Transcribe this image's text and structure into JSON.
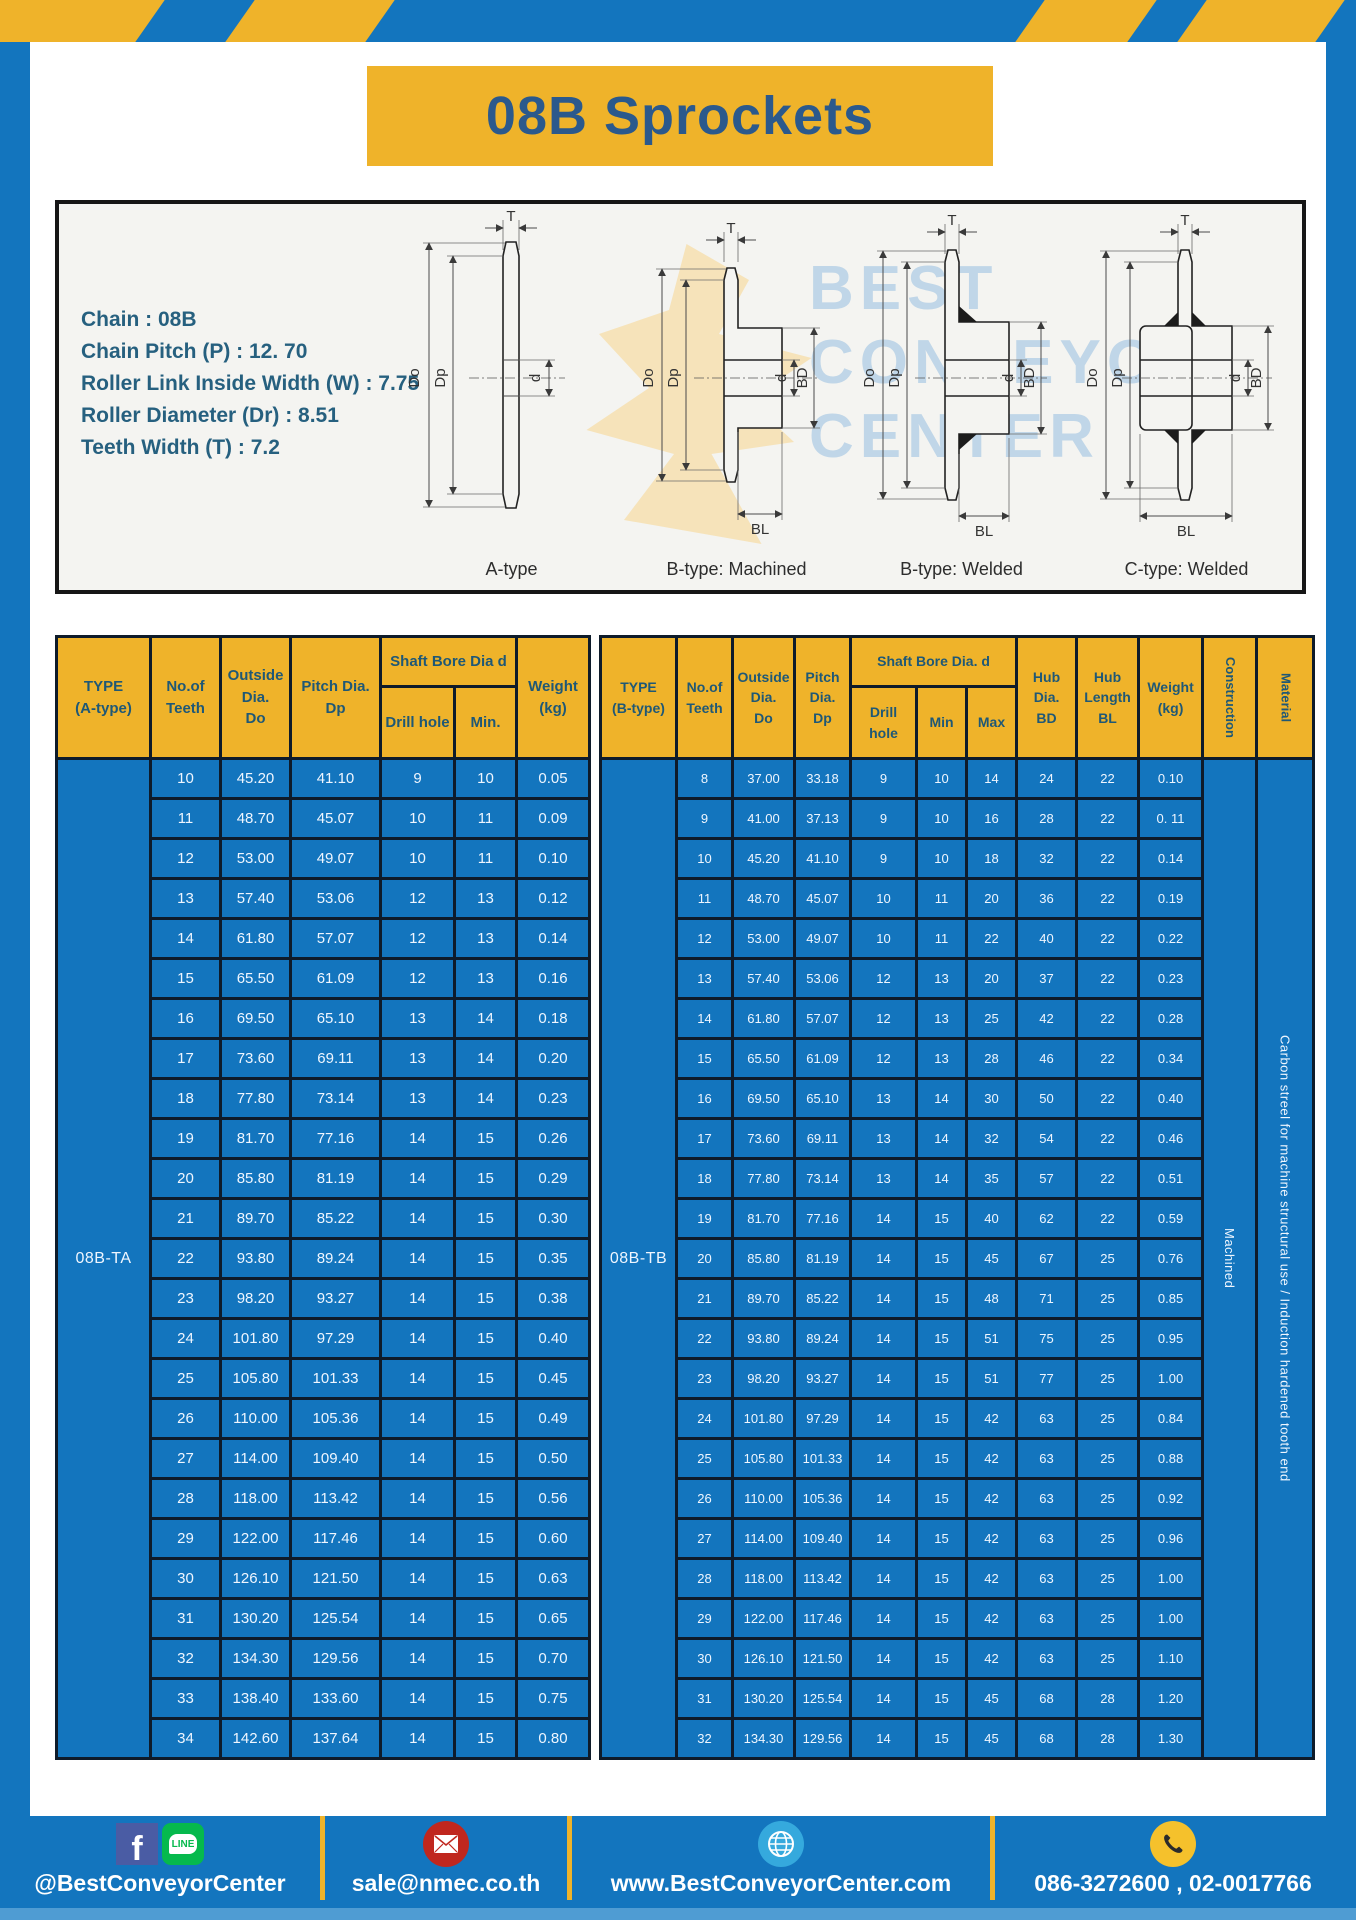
{
  "page": {
    "title": "08B Sprockets"
  },
  "specs": {
    "lines": [
      "Chain  : 08B",
      "Chain Pitch (P)  :  12. 70",
      "Roller Link Inside Width (W)  :  7.75",
      "Roller Diameter (Dr)  : 8.51",
      "Teeth Width (T)  :  7.2"
    ]
  },
  "diagram": {
    "types": [
      "A-type",
      "B-type: Machined",
      "B-type: Welded",
      "C-type: Welded"
    ],
    "dims": {
      "t": "T",
      "outside": "Do",
      "pitch": "Dp",
      "bore": "d",
      "hub_dia": "BD",
      "hub_len": "BL"
    },
    "watermark": [
      "BEST",
      "CONVEYOR",
      "CENTER"
    ]
  },
  "table_a": {
    "type_label": "08B-TA",
    "headers": {
      "type": "TYPE\n(A-type)",
      "teeth": "No.of\nTeeth",
      "outside": "Outside\nDia.\nDo",
      "pitch": "Pitch Dia.\nDp",
      "bore_group": "Shaft Bore Dia d",
      "drill": "Drill hole",
      "min": "Min.",
      "weight": "Weight\n(kg)"
    },
    "rows": [
      [
        "10",
        "45.20",
        "41.10",
        "9",
        "10",
        "0.05"
      ],
      [
        "11",
        "48.70",
        "45.07",
        "10",
        "11",
        "0.09"
      ],
      [
        "12",
        "53.00",
        "49.07",
        "10",
        "11",
        "0.10"
      ],
      [
        "13",
        "57.40",
        "53.06",
        "12",
        "13",
        "0.12"
      ],
      [
        "14",
        "61.80",
        "57.07",
        "12",
        "13",
        "0.14"
      ],
      [
        "15",
        "65.50",
        "61.09",
        "12",
        "13",
        "0.16"
      ],
      [
        "16",
        "69.50",
        "65.10",
        "13",
        "14",
        "0.18"
      ],
      [
        "17",
        "73.60",
        "69.11",
        "13",
        "14",
        "0.20"
      ],
      [
        "18",
        "77.80",
        "73.14",
        "13",
        "14",
        "0.23"
      ],
      [
        "19",
        "81.70",
        "77.16",
        "14",
        "15",
        "0.26"
      ],
      [
        "20",
        "85.80",
        "81.19",
        "14",
        "15",
        "0.29"
      ],
      [
        "21",
        "89.70",
        "85.22",
        "14",
        "15",
        "0.30"
      ],
      [
        "22",
        "93.80",
        "89.24",
        "14",
        "15",
        "0.35"
      ],
      [
        "23",
        "98.20",
        "93.27",
        "14",
        "15",
        "0.38"
      ],
      [
        "24",
        "101.80",
        "97.29",
        "14",
        "15",
        "0.40"
      ],
      [
        "25",
        "105.80",
        "101.33",
        "14",
        "15",
        "0.45"
      ],
      [
        "26",
        "110.00",
        "105.36",
        "14",
        "15",
        "0.49"
      ],
      [
        "27",
        "114.00",
        "109.40",
        "14",
        "15",
        "0.50"
      ],
      [
        "28",
        "118.00",
        "113.42",
        "14",
        "15",
        "0.56"
      ],
      [
        "29",
        "122.00",
        "117.46",
        "14",
        "15",
        "0.60"
      ],
      [
        "30",
        "126.10",
        "121.50",
        "14",
        "15",
        "0.63"
      ],
      [
        "31",
        "130.20",
        "125.54",
        "14",
        "15",
        "0.65"
      ],
      [
        "32",
        "134.30",
        "129.56",
        "14",
        "15",
        "0.70"
      ],
      [
        "33",
        "138.40",
        "133.60",
        "14",
        "15",
        "0.75"
      ],
      [
        "34",
        "142.60",
        "137.64",
        "14",
        "15",
        "0.80"
      ]
    ]
  },
  "table_b": {
    "type_label": "08B-TB",
    "construction": "Machined",
    "material": "Carbon streel for machine structural use / Induction hardened tooth end",
    "headers": {
      "type": "TYPE\n(B-type)",
      "teeth": "No.of\nTeeth",
      "outside": "Outside\nDia.\nDo",
      "pitch": "Pitch\nDia.\nDp",
      "bore_group": "Shaft Bore Dia.  d",
      "drill": "Drill hole",
      "min": "Min",
      "max": "Max",
      "hub_dia": "Hub\nDia.\nBD",
      "hub_len": "Hub\nLength\nBL",
      "weight": "Weight\n(kg)",
      "construction": "Construction",
      "material": "Material"
    },
    "rows": [
      [
        "8",
        "37.00",
        "33.18",
        "9",
        "10",
        "14",
        "24",
        "22",
        "0.10"
      ],
      [
        "9",
        "41.00",
        "37.13",
        "9",
        "10",
        "16",
        "28",
        "22",
        "0. 11"
      ],
      [
        "10",
        "45.20",
        "41.10",
        "9",
        "10",
        "18",
        "32",
        "22",
        "0.14"
      ],
      [
        "11",
        "48.70",
        "45.07",
        "10",
        "11",
        "20",
        "36",
        "22",
        "0.19"
      ],
      [
        "12",
        "53.00",
        "49.07",
        "10",
        "11",
        "22",
        "40",
        "22",
        "0.22"
      ],
      [
        "13",
        "57.40",
        "53.06",
        "12",
        "13",
        "20",
        "37",
        "22",
        "0.23"
      ],
      [
        "14",
        "61.80",
        "57.07",
        "12",
        "13",
        "25",
        "42",
        "22",
        "0.28"
      ],
      [
        "15",
        "65.50",
        "61.09",
        "12",
        "13",
        "28",
        "46",
        "22",
        "0.34"
      ],
      [
        "16",
        "69.50",
        "65.10",
        "13",
        "14",
        "30",
        "50",
        "22",
        "0.40"
      ],
      [
        "17",
        "73.60",
        "69.11",
        "13",
        "14",
        "32",
        "54",
        "22",
        "0.46"
      ],
      [
        "18",
        "77.80",
        "73.14",
        "13",
        "14",
        "35",
        "57",
        "22",
        "0.51"
      ],
      [
        "19",
        "81.70",
        "77.16",
        "14",
        "15",
        "40",
        "62",
        "22",
        "0.59"
      ],
      [
        "20",
        "85.80",
        "81.19",
        "14",
        "15",
        "45",
        "67",
        "25",
        "0.76"
      ],
      [
        "21",
        "89.70",
        "85.22",
        "14",
        "15",
        "48",
        "71",
        "25",
        "0.85"
      ],
      [
        "22",
        "93.80",
        "89.24",
        "14",
        "15",
        "51",
        "75",
        "25",
        "0.95"
      ],
      [
        "23",
        "98.20",
        "93.27",
        "14",
        "15",
        "51",
        "77",
        "25",
        "1.00"
      ],
      [
        "24",
        "101.80",
        "97.29",
        "14",
        "15",
        "42",
        "63",
        "25",
        "0.84"
      ],
      [
        "25",
        "105.80",
        "101.33",
        "14",
        "15",
        "42",
        "63",
        "25",
        "0.88"
      ],
      [
        "26",
        "110.00",
        "105.36",
        "14",
        "15",
        "42",
        "63",
        "25",
        "0.92"
      ],
      [
        "27",
        "114.00",
        "109.40",
        "14",
        "15",
        "42",
        "63",
        "25",
        "0.96"
      ],
      [
        "28",
        "118.00",
        "113.42",
        "14",
        "15",
        "42",
        "63",
        "25",
        "1.00"
      ],
      [
        "29",
        "122.00",
        "117.46",
        "14",
        "15",
        "42",
        "63",
        "25",
        "1.00"
      ],
      [
        "30",
        "126.10",
        "121.50",
        "14",
        "15",
        "42",
        "63",
        "25",
        "1.10"
      ],
      [
        "31",
        "130.20",
        "125.54",
        "14",
        "15",
        "45",
        "68",
        "28",
        "1.20"
      ],
      [
        "32",
        "134.30",
        "129.56",
        "14",
        "15",
        "45",
        "68",
        "28",
        "1.30"
      ]
    ]
  },
  "footer": {
    "facebook_glyph": "f",
    "line_label": "LINE",
    "social": "@BestConveyorCenter",
    "email": "sale@nmec.co.th",
    "website": "www.BestConveyorCenter.com",
    "phone": "086-3272600 , 02-0017766"
  },
  "colors": {
    "blue": "#1375BE",
    "yellow": "#EFB32A",
    "table_border": "#0E1B2A",
    "header_text": "#1F5876",
    "title_text": "#2B598C",
    "bottom_strip": "#4F9CD3"
  }
}
